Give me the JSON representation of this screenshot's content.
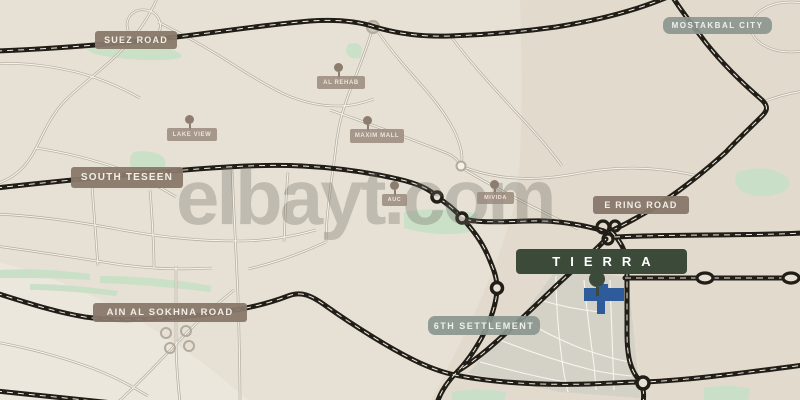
{
  "watermark": {
    "text": "elbayt.com"
  },
  "labels": {
    "roads": [
      {
        "text": "SUEZ ROAD"
      },
      {
        "text": "SOUTH TESEEN"
      },
      {
        "text": "AIN AL SOKHNA ROAD"
      },
      {
        "text": "E RING ROAD"
      }
    ],
    "districts": [
      {
        "text": "MOSTAKBAL CITY"
      },
      {
        "text": "6TH SETTLEMENT"
      }
    ],
    "pois": [
      {
        "text": "AL REHAB"
      },
      {
        "text": "LAKE VIEW"
      },
      {
        "text": "MAXIM MALL"
      },
      {
        "text": "AUC"
      },
      {
        "text": "MIVIDA"
      }
    ],
    "project": {
      "text": "TIERRA"
    }
  },
  "colors": {
    "background": "#e7e1d5",
    "highway": "#211d17",
    "secondary_road": "#b3ab9d",
    "park_green": "#c8dfc6",
    "road_label_bg": "#88786a",
    "district_label_bg": "#8b968f",
    "poi_label_bg": "#9c8c7f",
    "project_label_bg": "#3c4a39",
    "project_plot_blue": "#2e5c9a",
    "poi_pin": "#8d7d6f",
    "watermark_gray": "#6e6c64"
  }
}
